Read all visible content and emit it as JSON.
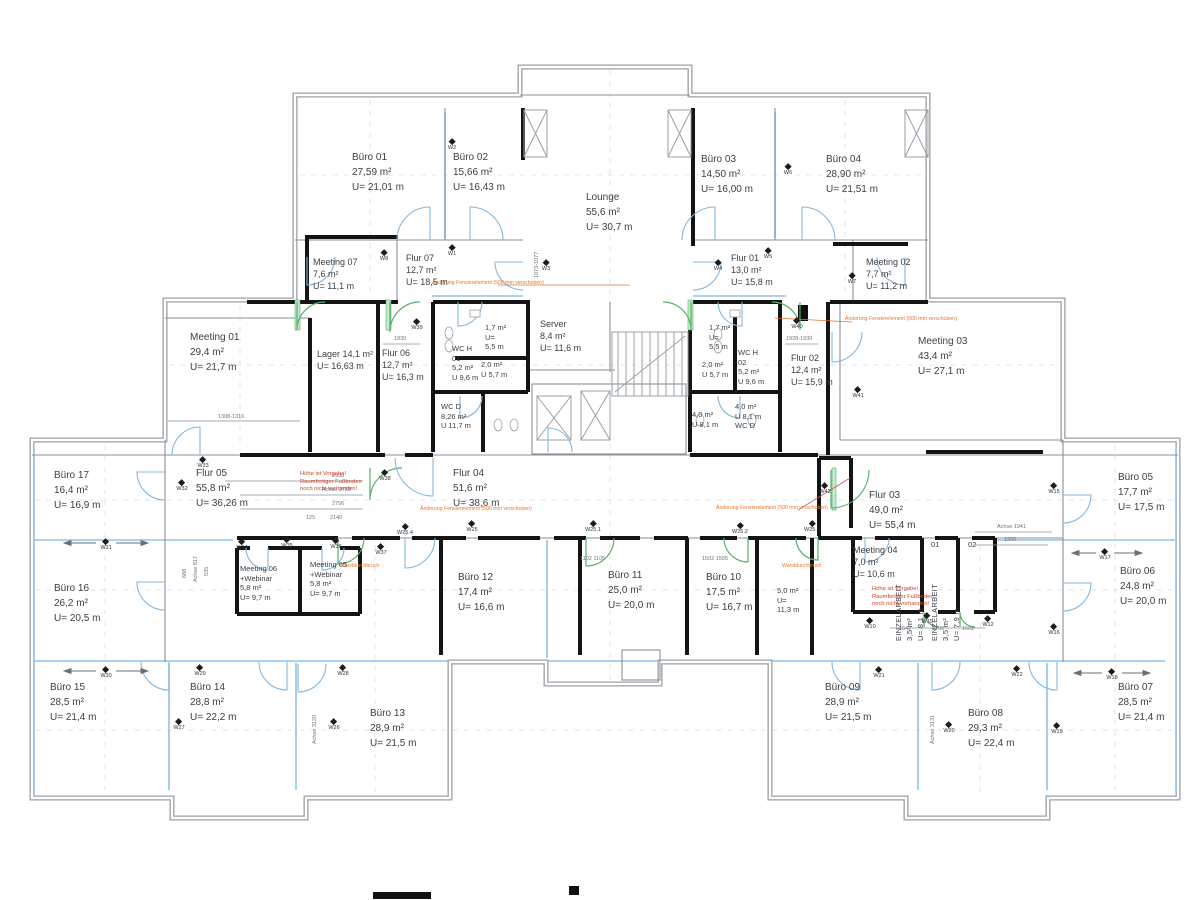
{
  "rooms": [
    {
      "id": "buero-01",
      "x": 352,
      "y": 150,
      "lines": [
        "Büro 01",
        "27,59 m²",
        "U= 21,01 m"
      ]
    },
    {
      "id": "buero-02",
      "x": 453,
      "y": 150,
      "lines": [
        "Büro 02",
        "15,66 m²",
        "U= 16,43 m"
      ]
    },
    {
      "id": "lounge",
      "x": 586,
      "y": 190,
      "lines": [
        "Lounge",
        "55,6 m²",
        "U= 30,7 m"
      ]
    },
    {
      "id": "buero-03",
      "x": 701,
      "y": 152,
      "lines": [
        "Büro 03",
        "14,50 m²",
        "U= 16,00 m"
      ]
    },
    {
      "id": "buero-04",
      "x": 826,
      "y": 152,
      "lines": [
        "Büro 04",
        "28,90 m²",
        "U= 21,51 m"
      ]
    },
    {
      "id": "meeting-07",
      "cls": "md",
      "x": 313,
      "y": 256,
      "lines": [
        "Meeting 07",
        "7,6 m²",
        "U= 11,1 m"
      ]
    },
    {
      "id": "flur-07",
      "cls": "md",
      "x": 406,
      "y": 252,
      "lines": [
        "Flur 07",
        "12,7 m²",
        "U= 18,5 m"
      ]
    },
    {
      "id": "flur-01",
      "cls": "md",
      "x": 731,
      "y": 252,
      "lines": [
        "Flur 01",
        "13,0 m²",
        "U= 15,8 m"
      ]
    },
    {
      "id": "meeting-02",
      "cls": "md",
      "x": 866,
      "y": 256,
      "lines": [
        "Meeting 02",
        "7,7 m²",
        "U= 11,2 m"
      ]
    },
    {
      "id": "meeting-01",
      "x": 190,
      "y": 330,
      "lines": [
        "Meeting 01",
        "29,4 m²",
        "U= 21,7 m"
      ]
    },
    {
      "id": "lager",
      "cls": "md",
      "x": 317,
      "y": 348,
      "lines": [
        "Lager   14,1 m²",
        "U= 16,63 m"
      ]
    },
    {
      "id": "flur-06",
      "cls": "md",
      "x": 382,
      "y": 347,
      "lines": [
        "Flur 06",
        "12,7 m²",
        "U= 16,3 m"
      ]
    },
    {
      "id": "wc-h-01",
      "cls": "sm",
      "x": 452,
      "y": 344,
      "lines": [
        "WC H",
        "01",
        "5,2 m²",
        "U 9,6 m"
      ]
    },
    {
      "id": "abstell-links",
      "cls": "sm",
      "x": 485,
      "y": 323,
      "lines": [
        "1,7 m²",
        "U=",
        "5,5 m"
      ]
    },
    {
      "id": "vorraum-links",
      "cls": "sm",
      "x": 481,
      "y": 360,
      "lines": [
        "2,0 m²",
        "U 5,7 m"
      ]
    },
    {
      "id": "server",
      "cls": "md",
      "x": 540,
      "y": 318,
      "lines": [
        "Server",
        "8,4 m²",
        "U= 11,6 m"
      ]
    },
    {
      "id": "wc-d-links",
      "cls": "sm",
      "x": 441,
      "y": 402,
      "lines": [
        "WC D",
        "8,26 m²",
        "U 11,7 m"
      ]
    },
    {
      "id": "abstell-rechts",
      "cls": "sm",
      "x": 709,
      "y": 323,
      "lines": [
        "1,7 m²",
        "U=",
        "5,5 m"
      ]
    },
    {
      "id": "vorraum-rechts",
      "cls": "sm",
      "x": 702,
      "y": 360,
      "lines": [
        "2,0 m²",
        "U 5,7 m"
      ]
    },
    {
      "id": "wc-h-02",
      "cls": "sm",
      "x": 738,
      "y": 348,
      "lines": [
        "WC H",
        "02",
        "5,2 m²",
        "U 9,6 m"
      ]
    },
    {
      "id": "nebenraum-40",
      "cls": "sm",
      "x": 692,
      "y": 410,
      "lines": [
        "4,0 m²",
        "U 8,1 m"
      ]
    },
    {
      "id": "wc-d-rechts",
      "cls": "sm",
      "x": 735,
      "y": 402,
      "lines": [
        "4,0 m²",
        "U 8,1 m",
        "WC D"
      ]
    },
    {
      "id": "flur-02",
      "cls": "md",
      "x": 791,
      "y": 352,
      "lines": [
        "Flur 02",
        "12,4 m²",
        "U= 15,9 m"
      ]
    },
    {
      "id": "meeting-03",
      "x": 918,
      "y": 334,
      "lines": [
        "Meeting 03",
        "43,4 m²",
        "U= 27,1 m"
      ]
    },
    {
      "id": "buero-17",
      "x": 54,
      "y": 468,
      "lines": [
        "Büro 17",
        "16,4 m²",
        "U= 16,9 m"
      ]
    },
    {
      "id": "flur-05",
      "x": 196,
      "y": 466,
      "lines": [
        "Flur 05",
        "55,8 m²",
        "U= 36,26 m"
      ]
    },
    {
      "id": "buero-16",
      "x": 54,
      "y": 581,
      "lines": [
        "Büro 16",
        "26,2 m²",
        "U= 20,5 m"
      ]
    },
    {
      "id": "meeting-06",
      "cls": "sm",
      "x": 240,
      "y": 564,
      "lines": [
        "Meeting 06",
        "+Webinar",
        "5,8 m²",
        "U= 9,7 m"
      ]
    },
    {
      "id": "meeting-05",
      "cls": "sm",
      "x": 310,
      "y": 560,
      "lines": [
        "Meeting 05",
        "+Webinar",
        "5,8 m²",
        "U= 9,7 m"
      ]
    },
    {
      "id": "flur-04",
      "x": 453,
      "y": 466,
      "lines": [
        "Flur 04",
        "51,6 m²",
        "U= 38,6 m"
      ]
    },
    {
      "id": "buero-12",
      "x": 458,
      "y": 570,
      "lines": [
        "Büro 12",
        "17,4 m²",
        "U= 16,6 m"
      ]
    },
    {
      "id": "buero-11",
      "x": 608,
      "y": 568,
      "lines": [
        "Büro 11",
        "25,0 m²",
        "U= 20,0 m"
      ]
    },
    {
      "id": "buero-10",
      "x": 706,
      "y": 570,
      "lines": [
        "Büro 10",
        "17,5 m²",
        "U= 16,7 m"
      ]
    },
    {
      "id": "raum-50",
      "cls": "sm",
      "x": 777,
      "y": 586,
      "lines": [
        "5,0 m²",
        "U=",
        "11,3 m"
      ]
    },
    {
      "id": "flur-03",
      "x": 869,
      "y": 488,
      "lines": [
        "Flur 03",
        "49,0 m²",
        "U= 55,4 m"
      ]
    },
    {
      "id": "meeting-04",
      "cls": "md",
      "x": 853,
      "y": 544,
      "lines": [
        "Meeting 04",
        "7,0 m²",
        "U= 10,6 m"
      ]
    },
    {
      "id": "einzel-01-nr",
      "cls": "sm",
      "x": 931,
      "y": 540,
      "lines": [
        "01"
      ]
    },
    {
      "id": "einzel-02-nr",
      "cls": "sm",
      "x": 968,
      "y": 540,
      "lines": [
        "02"
      ]
    },
    {
      "id": "einzelarbeit-01",
      "cls": "vert",
      "x": 926,
      "y": 608,
      "lines": [
        "EINZELARBEIT",
        "3,5 m²",
        "U= 8,1 m"
      ]
    },
    {
      "id": "einzelarbeit-02",
      "cls": "vert",
      "x": 962,
      "y": 608,
      "lines": [
        "EINZELARBEIT",
        "3,5 m²",
        "U= 7,9 m"
      ]
    },
    {
      "id": "buero-05",
      "x": 1118,
      "y": 470,
      "lines": [
        "Büro 05",
        "17,7 m²",
        "U= 17,5 m"
      ]
    },
    {
      "id": "buero-06",
      "x": 1120,
      "y": 564,
      "lines": [
        "Büro 06",
        "24,8 m²",
        "U= 20,0 m"
      ]
    },
    {
      "id": "buero-15",
      "x": 50,
      "y": 680,
      "lines": [
        "Büro 15",
        "28,5 m²",
        "U= 21,4 m"
      ]
    },
    {
      "id": "buero-14",
      "x": 190,
      "y": 680,
      "lines": [
        "Büro 14",
        "28,8 m²",
        "U= 22,2 m"
      ]
    },
    {
      "id": "buero-13",
      "x": 370,
      "y": 706,
      "lines": [
        "Büro 13",
        "28,9 m²",
        "U= 21,5 m"
      ]
    },
    {
      "id": "buero-09",
      "x": 825,
      "y": 680,
      "lines": [
        "Büro 09",
        "28,9 m²",
        "U= 21,5 m"
      ]
    },
    {
      "id": "buero-08",
      "x": 968,
      "y": 706,
      "lines": [
        "Büro 08",
        "29,3 m²",
        "U= 22,4 m"
      ]
    },
    {
      "id": "buero-07",
      "x": 1118,
      "y": 680,
      "lines": [
        "Büro 07",
        "28,5 m²",
        "U= 21,4 m"
      ]
    }
  ],
  "markers": [
    {
      "label": "W1",
      "x": 452,
      "y": 249
    },
    {
      "label": "W2",
      "x": 452,
      "y": 143
    },
    {
      "label": "W8",
      "x": 384,
      "y": 254
    },
    {
      "label": "W3",
      "x": 546,
      "y": 264
    },
    {
      "label": "W4",
      "x": 718,
      "y": 264
    },
    {
      "label": "W5",
      "x": 768,
      "y": 252
    },
    {
      "label": "W6",
      "x": 788,
      "y": 168
    },
    {
      "label": "W7",
      "x": 852,
      "y": 277
    },
    {
      "label": "W39",
      "x": 417,
      "y": 323
    },
    {
      "label": "W40",
      "x": 797,
      "y": 322
    },
    {
      "label": "W41",
      "x": 858,
      "y": 391
    },
    {
      "label": "W42",
      "x": 825,
      "y": 487
    },
    {
      "label": "W38",
      "x": 385,
      "y": 474
    },
    {
      "label": "W33",
      "x": 203,
      "y": 461
    },
    {
      "label": "W32",
      "x": 182,
      "y": 484
    },
    {
      "label": "W31",
      "x": 106,
      "y": 543
    },
    {
      "label": "W34",
      "x": 242,
      "y": 543
    },
    {
      "label": "W35",
      "x": 287,
      "y": 541
    },
    {
      "label": "W36",
      "x": 336,
      "y": 542
    },
    {
      "label": "W37",
      "x": 381,
      "y": 548
    },
    {
      "label": "W25.4",
      "x": 405,
      "y": 528
    },
    {
      "label": "W25",
      "x": 472,
      "y": 525
    },
    {
      "label": "W25.1",
      "x": 593,
      "y": 525
    },
    {
      "label": "W25.2",
      "x": 740,
      "y": 527
    },
    {
      "label": "W25.3",
      "x": 812,
      "y": 525
    },
    {
      "label": "W30",
      "x": 106,
      "y": 671
    },
    {
      "label": "W29",
      "x": 200,
      "y": 669
    },
    {
      "label": "W28",
      "x": 343,
      "y": 669
    },
    {
      "label": "W27",
      "x": 179,
      "y": 723
    },
    {
      "label": "W26",
      "x": 334,
      "y": 723
    },
    {
      "label": "W21",
      "x": 879,
      "y": 671
    },
    {
      "label": "W22",
      "x": 1017,
      "y": 670
    },
    {
      "label": "W18",
      "x": 1112,
      "y": 673
    },
    {
      "label": "W20",
      "x": 949,
      "y": 726
    },
    {
      "label": "W19",
      "x": 1057,
      "y": 727
    },
    {
      "label": "W15",
      "x": 1054,
      "y": 487
    },
    {
      "label": "W17",
      "x": 1105,
      "y": 553
    },
    {
      "label": "W16",
      "x": 1054,
      "y": 628
    },
    {
      "label": "W10",
      "x": 870,
      "y": 622
    },
    {
      "label": "W11",
      "x": 927,
      "y": 617
    },
    {
      "label": "W12",
      "x": 988,
      "y": 620
    }
  ],
  "annotations": {
    "red": [
      {
        "x": 300,
        "y": 471,
        "lines": [
          "Höhe ist Vorgabe!",
          "Raumfertiger Fußboden",
          "noch nicht vorhanden!"
        ]
      },
      {
        "x": 872,
        "y": 586,
        "lines": [
          "Höhe ist Vorgabe!",
          "Raumfertiger Fußboden",
          "noch nicht vorhanden!"
        ]
      }
    ],
    "orange": [
      {
        "x": 432,
        "y": 280,
        "text": "Änderung Fensterelement (500 mm verschoben)"
      },
      {
        "x": 420,
        "y": 506,
        "text": "Änderung Fensterelement (500 mm verschoben)"
      },
      {
        "x": 716,
        "y": 505,
        "text": "Änderung Fensterelement (500 mm verschoben)"
      },
      {
        "x": 845,
        "y": 316,
        "text": "Änderung Fensterelement (500 mm verschoben)"
      },
      {
        "x": 340,
        "y": 563,
        "text": "Wanddurchbruch"
      },
      {
        "x": 782,
        "y": 563,
        "text": "Wanddurchbruch"
      }
    ]
  },
  "dims": [
    {
      "t": "2938",
      "x": 332,
      "y": 473
    },
    {
      "t": "Achse 2750",
      "x": 322,
      "y": 487
    },
    {
      "t": "2756",
      "x": 332,
      "y": 501
    },
    {
      "t": "125",
      "x": 306,
      "y": 515
    },
    {
      "t": "2140",
      "x": 330,
      "y": 515
    },
    {
      "t": "1308-1316",
      "x": 218,
      "y": 414
    },
    {
      "t": "1830",
      "x": 394,
      "y": 336
    },
    {
      "t": "1928-1930",
      "x": 786,
      "y": 336
    },
    {
      "t": "Achse 1941",
      "x": 997,
      "y": 524
    },
    {
      "t": "1900",
      "x": 1004,
      "y": 537
    },
    {
      "t": "1102 1105",
      "x": 580,
      "y": 556
    },
    {
      "t": "1502 1505",
      "x": 702,
      "y": 556
    },
    {
      "t": "1642",
      "x": 899,
      "y": 626
    },
    {
      "t": "1700",
      "x": 932,
      "y": 626
    },
    {
      "t": "1502",
      "x": 962,
      "y": 626
    },
    {
      "t": "1073-1077",
      "x": 540,
      "y": 272,
      "r": -90
    },
    {
      "t": "Achse 3120",
      "x": 318,
      "y": 738,
      "r": -90
    },
    {
      "t": "Achse 3131",
      "x": 936,
      "y": 738,
      "r": -90
    },
    {
      "t": "688",
      "x": 188,
      "y": 572,
      "r": -90
    },
    {
      "t": "Achse 817",
      "x": 199,
      "y": 576,
      "r": -90
    },
    {
      "t": "535",
      "x": 210,
      "y": 570,
      "r": -90
    }
  ]
}
